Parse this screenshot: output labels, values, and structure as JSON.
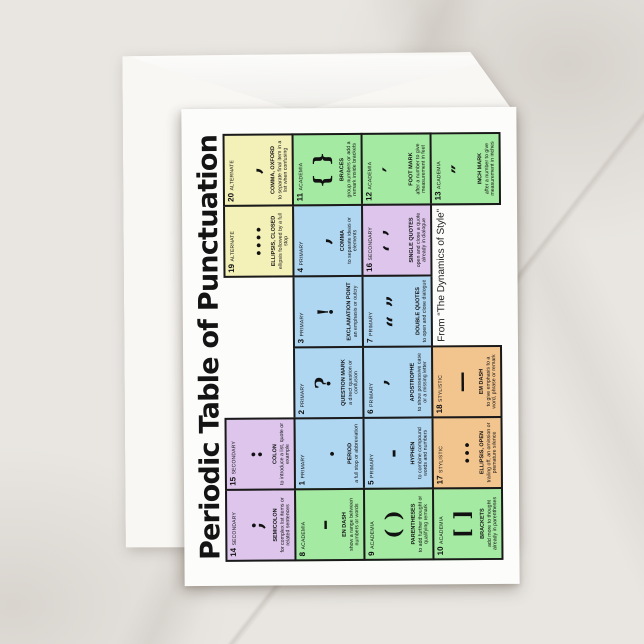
{
  "scene": {
    "background": "#e9e6e2",
    "envelope_color": "#f8f7f4",
    "card_color": "#fcfcfa",
    "border_color": "#1a1a1a",
    "text_color": "#111111"
  },
  "title": "Periodic Table of Punctuation",
  "attribution": "From “The Dynamics of Style”",
  "category_colors": {
    "PRIMARY": "#b0d7f2",
    "SECONDARY": "#ddc5ec",
    "ALTERNATE": "#f3f0b8",
    "ACADEMIA": "#a4eaa2",
    "STYLISTIC": "#f2c48e"
  },
  "elements": [
    {
      "number": 1,
      "category": "PRIMARY",
      "symbol": ".",
      "name": "PERIOD",
      "description": "a full stop or abbreviation",
      "row": 2,
      "col": 2
    },
    {
      "number": 2,
      "category": "PRIMARY",
      "symbol": "?",
      "name": "QUESTION MARK",
      "description": "a direct question or confusion",
      "row": 2,
      "col": 3
    },
    {
      "number": 3,
      "category": "PRIMARY",
      "symbol": "!",
      "name": "EXCLAMATION POINT",
      "description": "an emphasis or outcry",
      "row": 2,
      "col": 4
    },
    {
      "number": 4,
      "category": "PRIMARY",
      "symbol": ",",
      "name": "COMMA",
      "description": "to separate ideas or elements",
      "row": 2,
      "col": 5
    },
    {
      "number": 5,
      "category": "PRIMARY",
      "symbol": "-",
      "name": "HYPHEN",
      "description": "to combine compound words and numbers",
      "row": 3,
      "col": 2
    },
    {
      "number": 6,
      "category": "PRIMARY",
      "symbol": "’",
      "name": "APOSTROPHE",
      "description": "to show possessive case or a missing letter",
      "row": 3,
      "col": 3
    },
    {
      "number": 7,
      "category": "PRIMARY",
      "symbol": "“ ”",
      "name": "DOUBLE QUOTES",
      "description": "to open and close dialogue",
      "row": 3,
      "col": 4
    },
    {
      "number": 8,
      "category": "ACADEMIA",
      "symbol": "–",
      "name": "EN DASH",
      "description": "show a range between numbers or words",
      "row": 2,
      "col": 1
    },
    {
      "number": 9,
      "category": "ACADEMIA",
      "symbol": "( )",
      "name": "PARENTHESES",
      "description": "to add further thought or qualifying remark",
      "row": 3,
      "col": 1
    },
    {
      "number": 10,
      "category": "ACADEMIA",
      "symbol": "[ ]",
      "name": "BRACKETS",
      "description": "add more to thought already in parentheses",
      "row": 4,
      "col": 1
    },
    {
      "number": 11,
      "category": "ACADEMIA",
      "symbol": "{ }",
      "name": "BRACES",
      "description": "group numbers or add a remark inside brackets",
      "row": 2,
      "col": 6
    },
    {
      "number": 12,
      "category": "ACADEMIA",
      "symbol": "′",
      "name": "FOOT MARK",
      "description": "after a number to give measurement in feet",
      "row": 3,
      "col": 6
    },
    {
      "number": 13,
      "category": "ACADEMIA",
      "symbol": "″",
      "name": "INCH MARK",
      "description": "after a number to give measurement in inches",
      "row": 4,
      "col": 6
    },
    {
      "number": 14,
      "category": "SECONDARY",
      "symbol": ";",
      "name": "SEMICOLON",
      "description": "for complex list items or related sentences",
      "row": 1,
      "col": 1
    },
    {
      "number": 15,
      "category": "SECONDARY",
      "symbol": ":",
      "name": "COLON",
      "description": "to introduce a list, quote or example",
      "row": 1,
      "col": 2
    },
    {
      "number": 16,
      "category": "SECONDARY",
      "symbol": "‘ ’",
      "name": "SINGLE QUOTES",
      "description": "open and close a quote already in dialogue",
      "row": 3,
      "col": 5
    },
    {
      "number": 17,
      "category": "STYLISTIC",
      "symbol": "...",
      "name": "ELLIPSIS, OPEN",
      "description": "trailing off, an omission or premature silence",
      "row": 4,
      "col": 2
    },
    {
      "number": 18,
      "category": "STYLISTIC",
      "symbol": "—",
      "name": "EM DASH",
      "description": "to give emphasis to a word, phrase or remark",
      "row": 4,
      "col": 3
    },
    {
      "number": 19,
      "category": "ALTERNATE",
      "symbol": "....",
      "name": "ELLIPSIS, CLOSED",
      "description": "ellipsis followed by a full stop",
      "row": 1,
      "col": 5
    },
    {
      "number": 20,
      "category": "ALTERNATE",
      "symbol": ",",
      "name": "COMMA, OXFORD",
      "description": "to separate final item in a list when confusing",
      "row": 1,
      "col": 6
    }
  ]
}
